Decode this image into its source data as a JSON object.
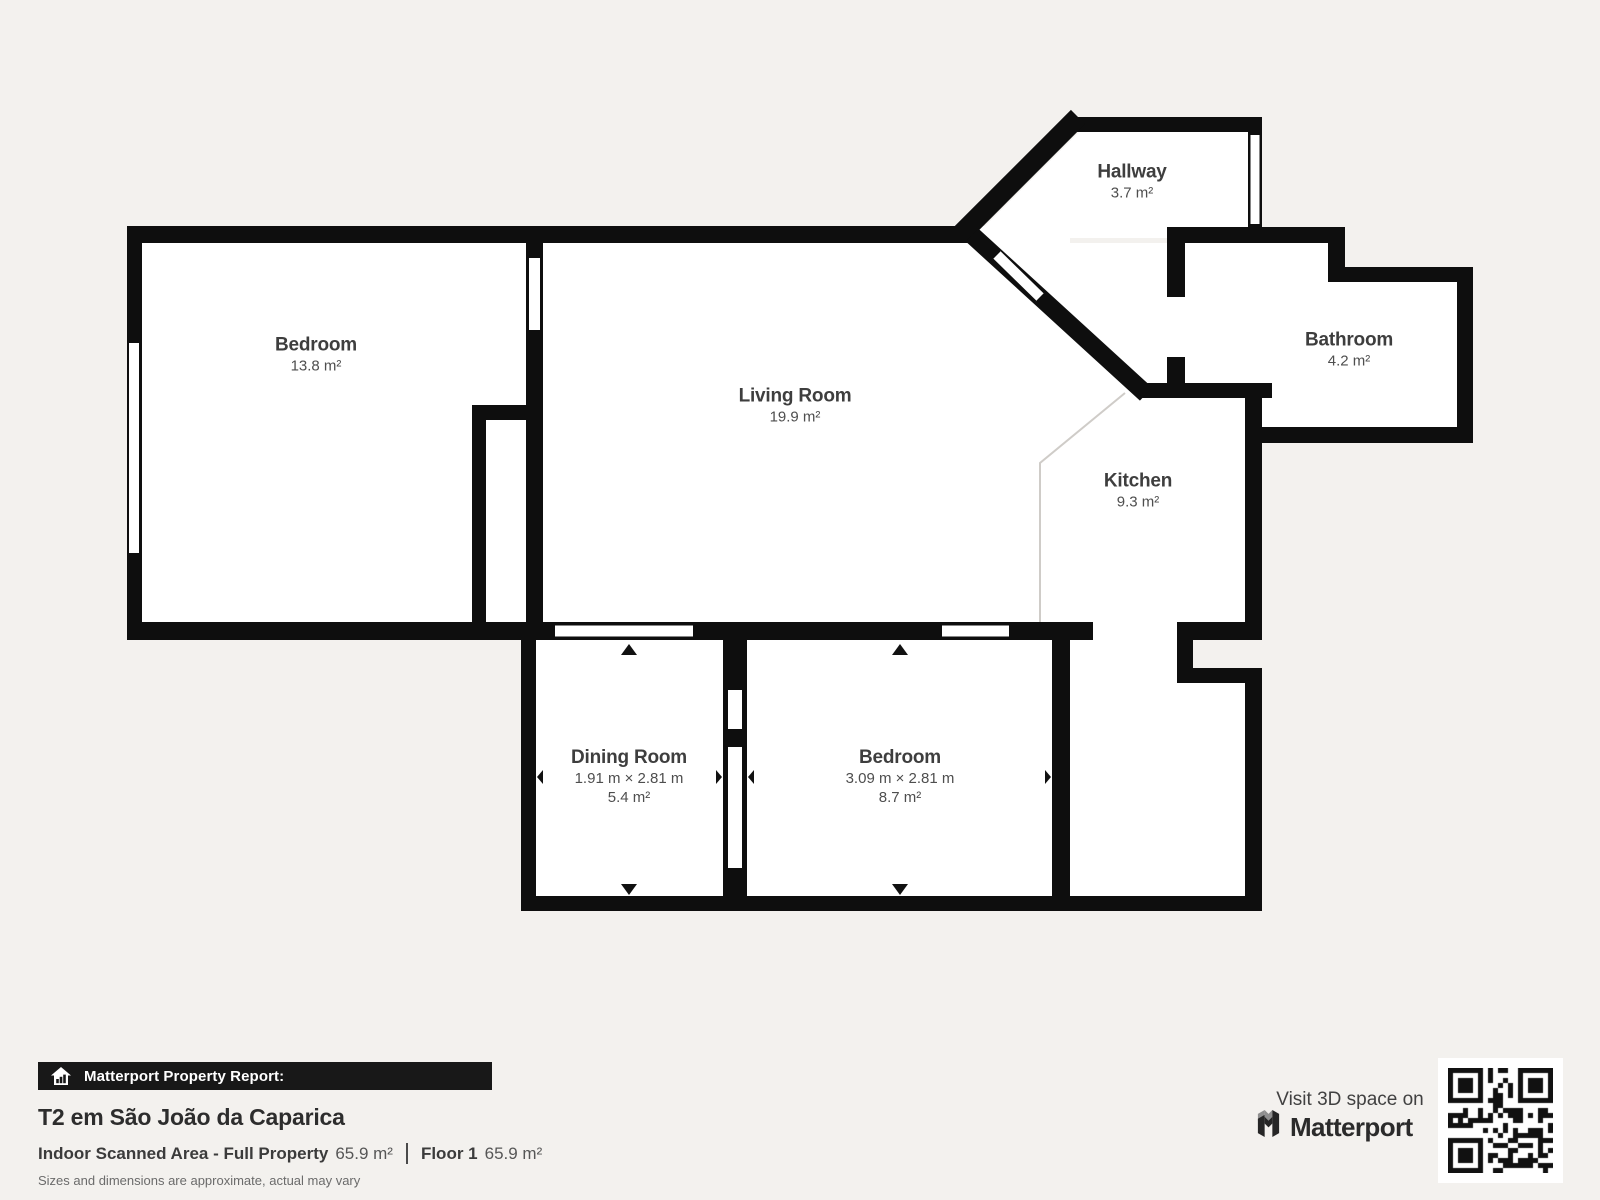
{
  "floorplan": {
    "rooms": [
      {
        "name": "Bedroom",
        "area": "13.8 m²"
      },
      {
        "name": "Living Room",
        "area": "19.9 m²"
      },
      {
        "name": "Hallway",
        "area": "3.7 m²"
      },
      {
        "name": "Bathroom",
        "area": "4.2 m²"
      },
      {
        "name": "Kitchen",
        "area": "9.3 m²"
      },
      {
        "name": "Dining Room",
        "dims": "1.91 m × 2.81 m",
        "area": "5.4 m²"
      },
      {
        "name": "Bedroom",
        "dims": "3.09 m × 2.81 m",
        "area": "8.7 m²"
      }
    ]
  },
  "report": {
    "banner_label": "Matterport Property Report:",
    "property_title": "T2 em São João da Caparica",
    "scanned_area_label": "Indoor Scanned Area - Full Property",
    "scanned_area_value": "65.9 m²",
    "floor_label": "Floor 1",
    "floor_value": "65.9 m²",
    "disclaimer": "Sizes and dimensions are approximate, actual may vary"
  },
  "cta": {
    "visit_label": "Visit 3D space on",
    "brand": "Matterport"
  },
  "colors": {
    "wall": "#0e0e0e",
    "background": "#f3f1ee",
    "room_fill": "#ffffff",
    "open_boundary": "#cfccc8"
  }
}
